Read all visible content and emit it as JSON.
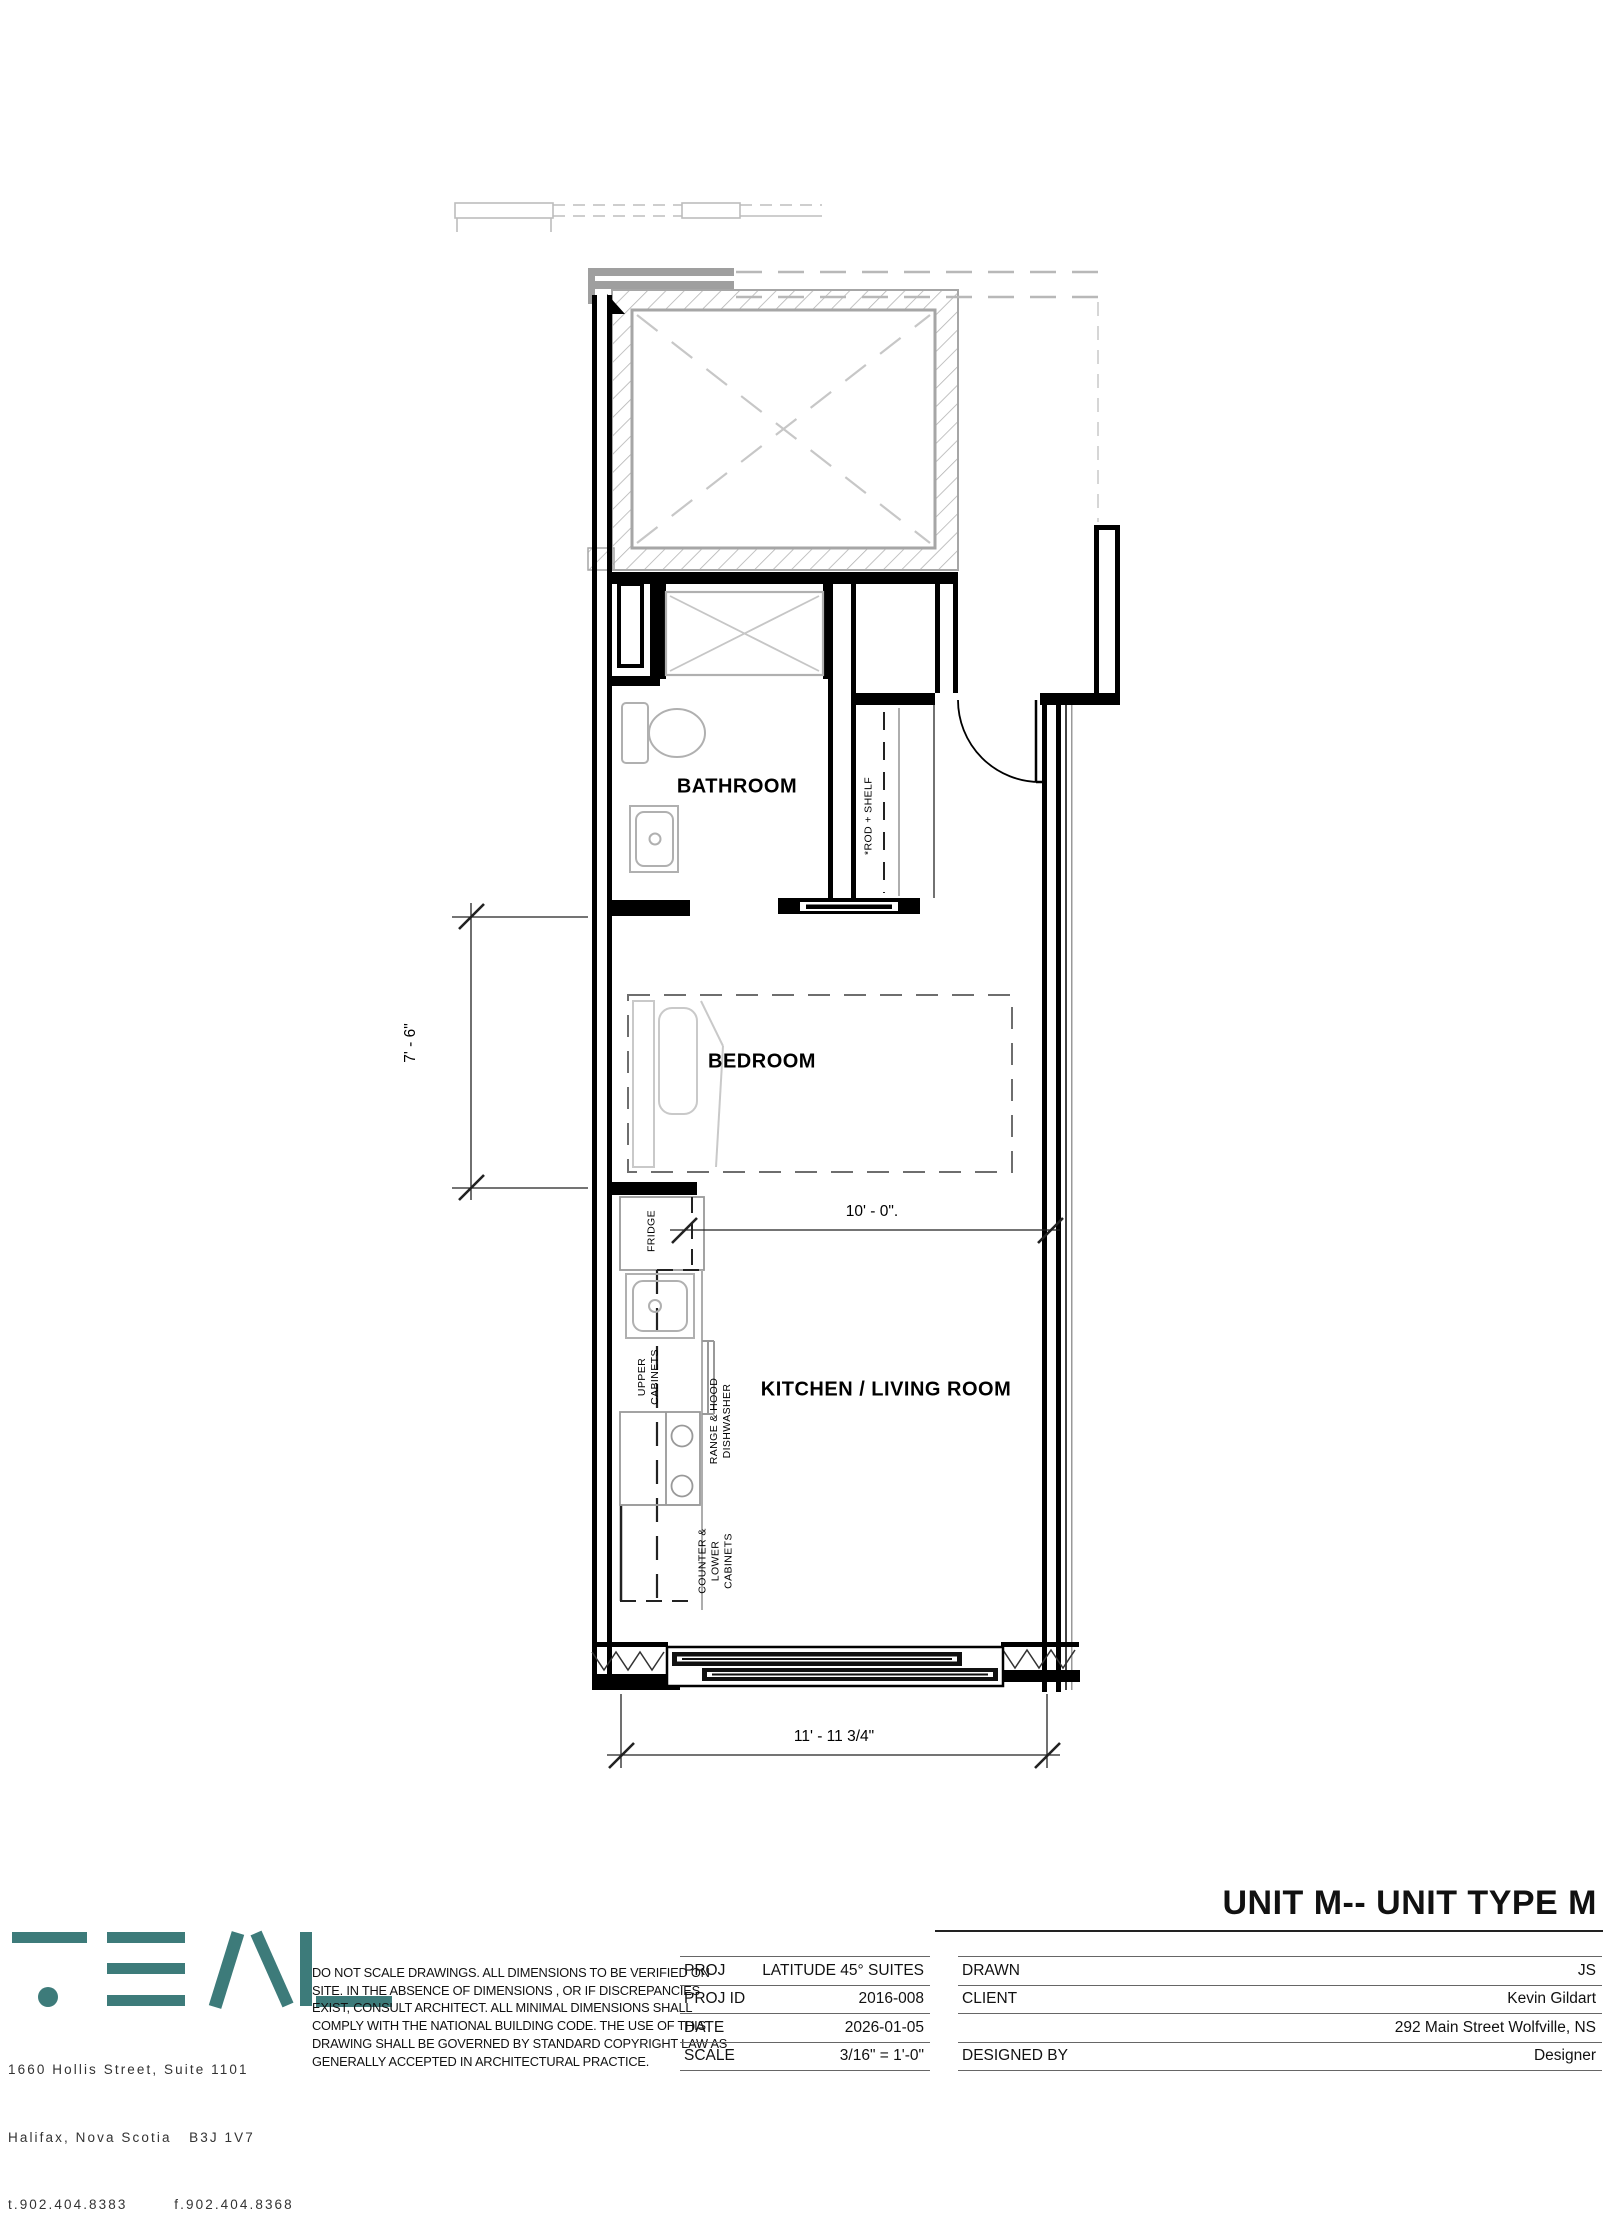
{
  "sheet": {
    "title": "UNIT M-- UNIT TYPE M"
  },
  "plan": {
    "rooms": {
      "bathroom": "BATHROOM",
      "bedroom": "BEDROOM",
      "kitchen_living": "KITCHEN / LIVING ROOM"
    },
    "fixtures": {
      "rod_shelf": "*ROD + SHELF",
      "fridge": "FRIDGE",
      "upper_cabinets": "UPPER\nCABINETS",
      "range_dishwasher": "RANGE & HOOD\nDISHWASHER",
      "counter_lower": "COUNTER &\nLOWER\nCABINETS"
    },
    "dimensions": {
      "bedroom_width": "7' - 6\"",
      "living_width": "10' - 0\".",
      "unit_width": "11' - 11 3/4\""
    }
  },
  "title_block": {
    "project_table": [
      {
        "label": "PROJ",
        "value": "LATITUDE 45° SUITES"
      },
      {
        "label": "PROJ ID",
        "value": "2016-008"
      },
      {
        "label": "DATE",
        "value": "2026-01-05"
      },
      {
        "label": "SCALE",
        "value": "3/16\" = 1'-0\""
      }
    ],
    "info_table": [
      {
        "label": "DRAWN",
        "value": "JS"
      },
      {
        "label": "CLIENT",
        "value": "Kevin Gildart"
      },
      {
        "label": "",
        "value": "292 Main Street Wolfville, NS"
      },
      {
        "label": "DESIGNED BY",
        "value": "Designer"
      }
    ],
    "disclaimer": {
      "l1": "DO NOT SCALE DRAWINGS. ALL DIMENSIONS TO BE VERIFIED  ON",
      "l2": "SITE. IN THE ABSENCE OF DIMENSIONS , OR IF DISCREPANCIES",
      "l3": "EXIST, CONSULT ARCHITECT. ALL MINIMAL  DIMENSIONS SHALL",
      "l4": "COMPLY WITH THE NATIONAL BUILDING CODE. THE USE OF THIS",
      "l5": "DRAWING SHALL BE GOVERNED BY STANDARD COPYRIGHT LAW AS",
      "l6": "GENERALLY ACCEPTED IN ARCHITECTURAL PRACTICE.",
      "brand_color": "#3d7b7a"
    },
    "firm": {
      "address_line1": "1660 Hollis Street, Suite 1101",
      "address_line2": "Halifax, Nova Scotia   B3J 1V7",
      "address_line3": "t.902.404.8383        f.902.404.8368"
    }
  }
}
